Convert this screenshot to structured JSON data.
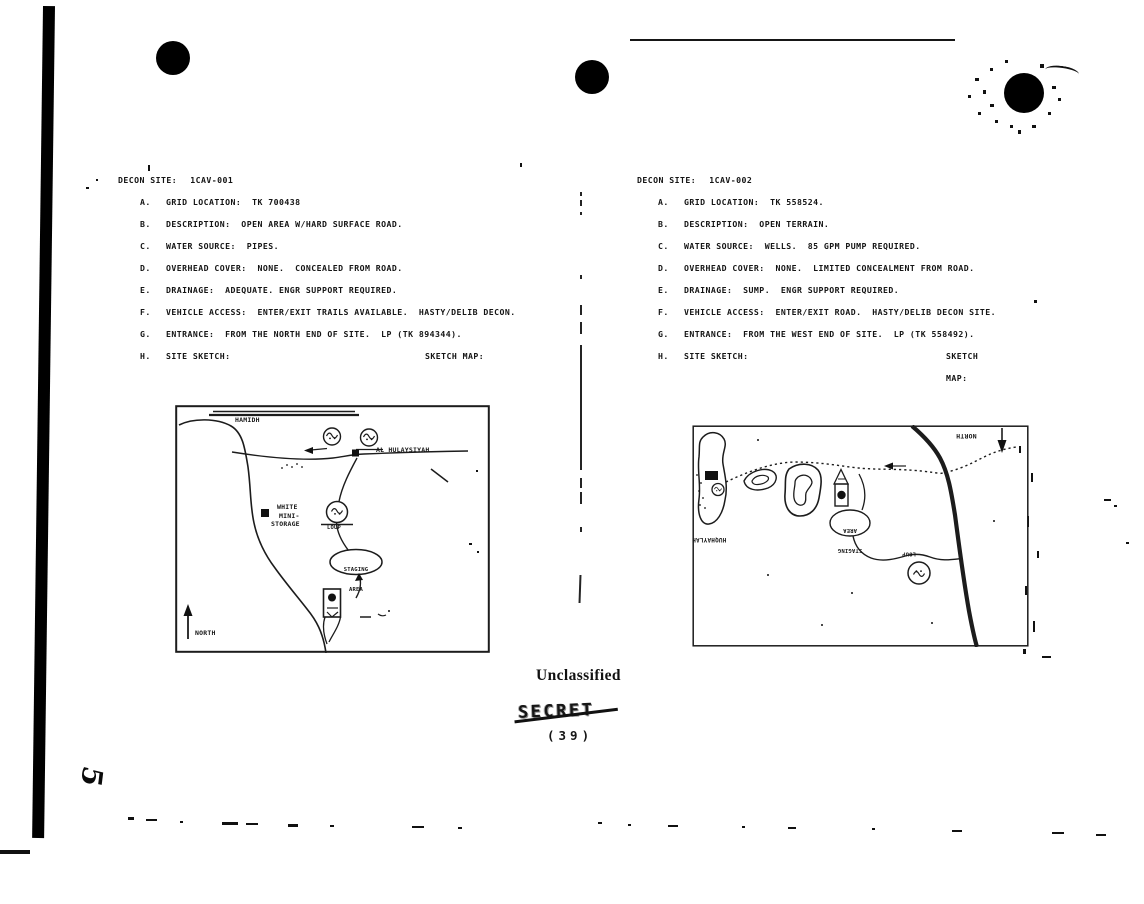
{
  "page": {
    "unclassified_stamp": "Unclassified",
    "struck_out_stamp": "SECRET",
    "page_number": "(39)",
    "handwritten_mark": "5"
  },
  "sites": [
    {
      "header_label": "DECON SITE:",
      "header_value": "1CAV-001",
      "items": [
        {
          "letter": "A.",
          "text": "GRID LOCATION:  TK 700438"
        },
        {
          "letter": "B.",
          "text": "DESCRIPTION:  OPEN AREA W/HARD SURFACE ROAD."
        },
        {
          "letter": "C.",
          "text": "WATER SOURCE:  PIPES."
        },
        {
          "letter": "D.",
          "text": "OVERHEAD COVER:  NONE.  CONCEALED FROM ROAD."
        },
        {
          "letter": "E.",
          "text": "DRAINAGE:  ADEQUATE. ENGR SUPPORT REQUIRED."
        },
        {
          "letter": "F.",
          "text": "VEHICLE ACCESS:  ENTER/EXIT TRAILS AVAILABLE.  HASTY/DELIB DECON."
        },
        {
          "letter": "G.",
          "text": "ENTRANCE:  FROM THE NORTH END OF SITE.  LP (TK 894344)."
        },
        {
          "letter": "H.",
          "text": "SITE SKETCH:"
        }
      ],
      "sketch_map_label": "SKETCH MAP:",
      "map": {
        "road_label": "HAMIDH",
        "town_label": "AL HULAYSIYAH",
        "storage_label_lines": [
          "WHITE",
          "MINI-",
          "STORAGE"
        ],
        "loup_label": "LOUP",
        "staging_area_lines": [
          "STAGING",
          "AREA"
        ],
        "north_label": "NORTH"
      }
    },
    {
      "header_label": "DECON SITE:",
      "header_value": "1CAV-002",
      "items": [
        {
          "letter": "A.",
          "text": "GRID LOCATION:  TK 558524."
        },
        {
          "letter": "B.",
          "text": "DESCRIPTION:  OPEN TERRAIN."
        },
        {
          "letter": "C.",
          "text": "WATER SOURCE:  WELLS.  85 GPM PUMP REQUIRED."
        },
        {
          "letter": "D.",
          "text": "OVERHEAD COVER:  NONE.  LIMITED CONCEALMENT FROM ROAD."
        },
        {
          "letter": "E.",
          "text": "DRAINAGE:  SUMP.  ENGR SUPPORT REQUIRED."
        },
        {
          "letter": "F.",
          "text": "VEHICLE ACCESS:  ENTER/EXIT ROAD.  HASTY/DELIB DECON SITE."
        },
        {
          "letter": "G.",
          "text": "ENTRANCE:  FROM THE WEST END OF SITE.  LP (TK 558492)."
        },
        {
          "letter": "H.",
          "text": "SITE SKETCH:"
        }
      ],
      "sketch_map_label": "SKETCH MAP:",
      "map": {
        "north_label": "NORTH",
        "town_label": "HUQHAYLAH",
        "staging_area_lines": [
          "STAGING",
          "AREA"
        ],
        "loup_label": "LOUP"
      }
    }
  ]
}
